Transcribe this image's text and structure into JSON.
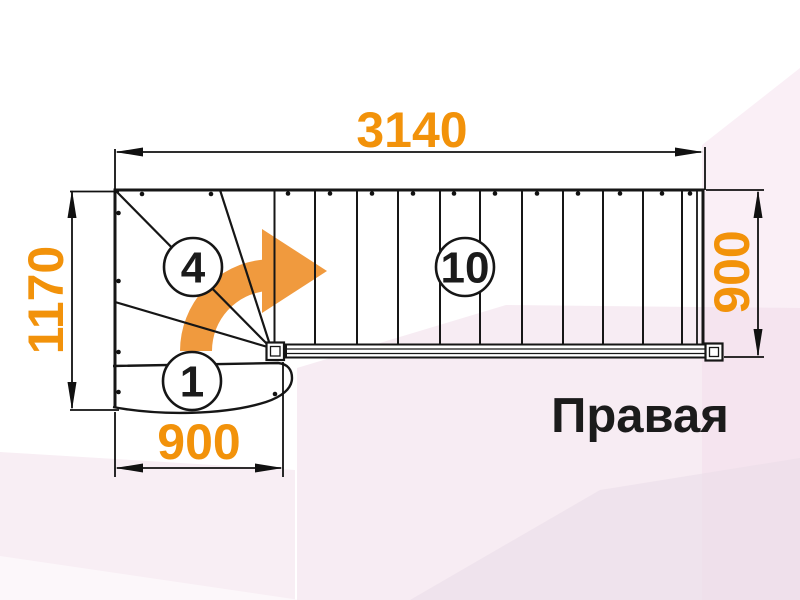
{
  "diagram": {
    "type": "stair-plan",
    "direction_label": "Правая",
    "dimensions": {
      "total_length": "3140",
      "left_depth": "1170",
      "right_width": "900",
      "bottom_width": "900"
    },
    "step_labels": {
      "first_step": "1",
      "winder_section": "4",
      "straight_flight": "10"
    },
    "colors": {
      "dimension_text_orange": "#F2920A",
      "turn_arrow_orange": "#F09A3E",
      "drawing_line_black": "#161616",
      "direction_text_black": "#1B1B1B",
      "background_pink": "#F7E7F0"
    }
  }
}
